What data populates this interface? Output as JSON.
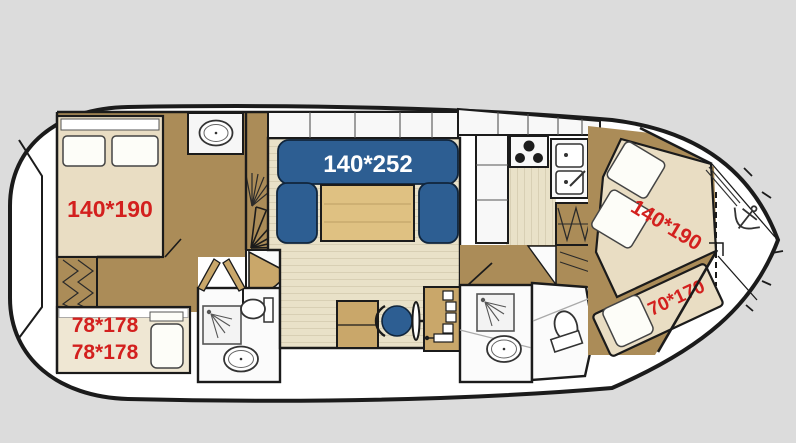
{
  "plan": {
    "type": "boat-floor-plan",
    "labels": {
      "aft_cabin_bed": "140*190",
      "salon_sofa": "140*252",
      "bow_cabin_bed": "140*190",
      "bow_bench": "70*170",
      "bunk_bed_upper": "78*178",
      "bunk_bed_lower": "78*178"
    },
    "colors": {
      "background": "#dcdcdc",
      "hull_white": "#ffffff",
      "outline": "#1b1b1b",
      "floor_dark_tan": "#ab8c58",
      "floor_light": "#e9e1c8",
      "bed_beige": "#e9ddc3",
      "room_white": "#fbfbfb",
      "table_wood": "#dfc182",
      "furniture_tan": "#c9a76a",
      "sofa_blue": "#2d5e92",
      "label_red": "#d3201e",
      "label_white": "#ffffff"
    },
    "icons": [
      "sink-icon",
      "toilet-icon",
      "shower-icon",
      "stove-icon",
      "double-sink-icon",
      "anchor-icon",
      "steering-wheel-icon",
      "helm-chair-icon",
      "spiral-stairs-icon",
      "wardrobe-icon",
      "pillow-icon",
      "door-swing-icon"
    ]
  }
}
